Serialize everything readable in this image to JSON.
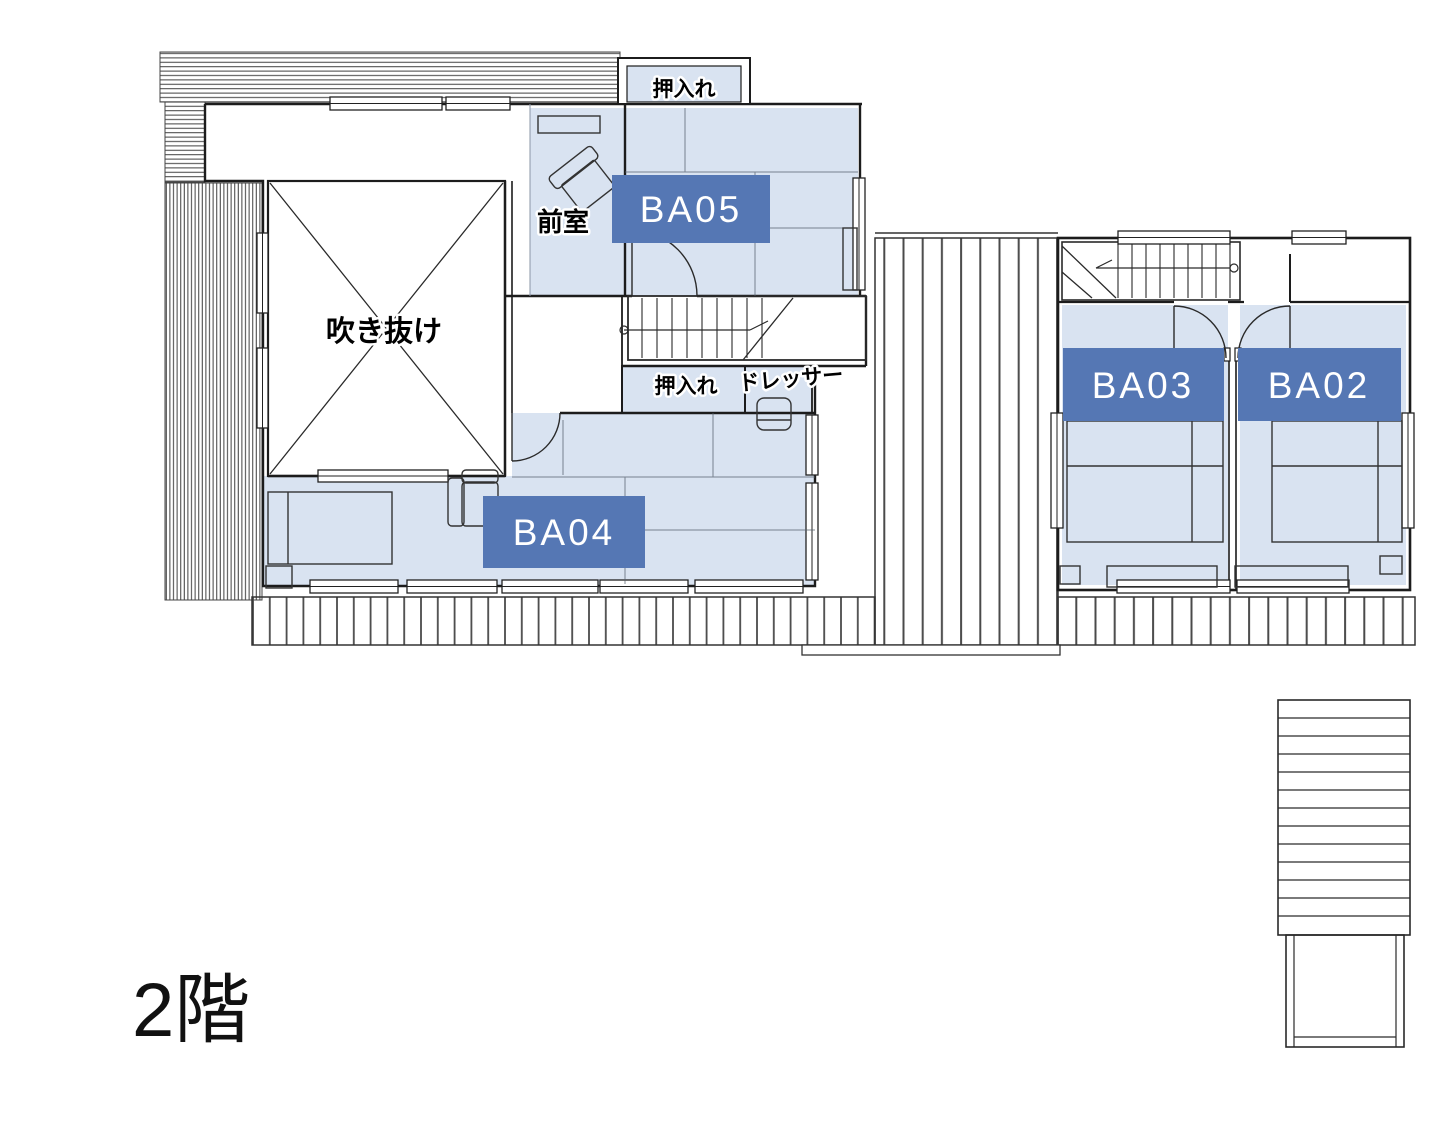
{
  "floor_plan": {
    "title": "2階",
    "rooms": [
      {
        "id": "ba05",
        "label": "BA05"
      },
      {
        "id": "ba04",
        "label": "BA04"
      },
      {
        "id": "ba03",
        "label": "BA03"
      },
      {
        "id": "ba02",
        "label": "BA02"
      }
    ],
    "annotations": {
      "closet_top": "押入れ",
      "closet_middle": "押入れ",
      "anteroom": "前室",
      "dresser": "ドレッサー",
      "atrium": "吹き抜け"
    },
    "colors": {
      "room_fill": "#d9e3f1",
      "tag_bg": "#5577b4",
      "tag_text": "#ffffff",
      "line": "#1c1c1c"
    }
  }
}
